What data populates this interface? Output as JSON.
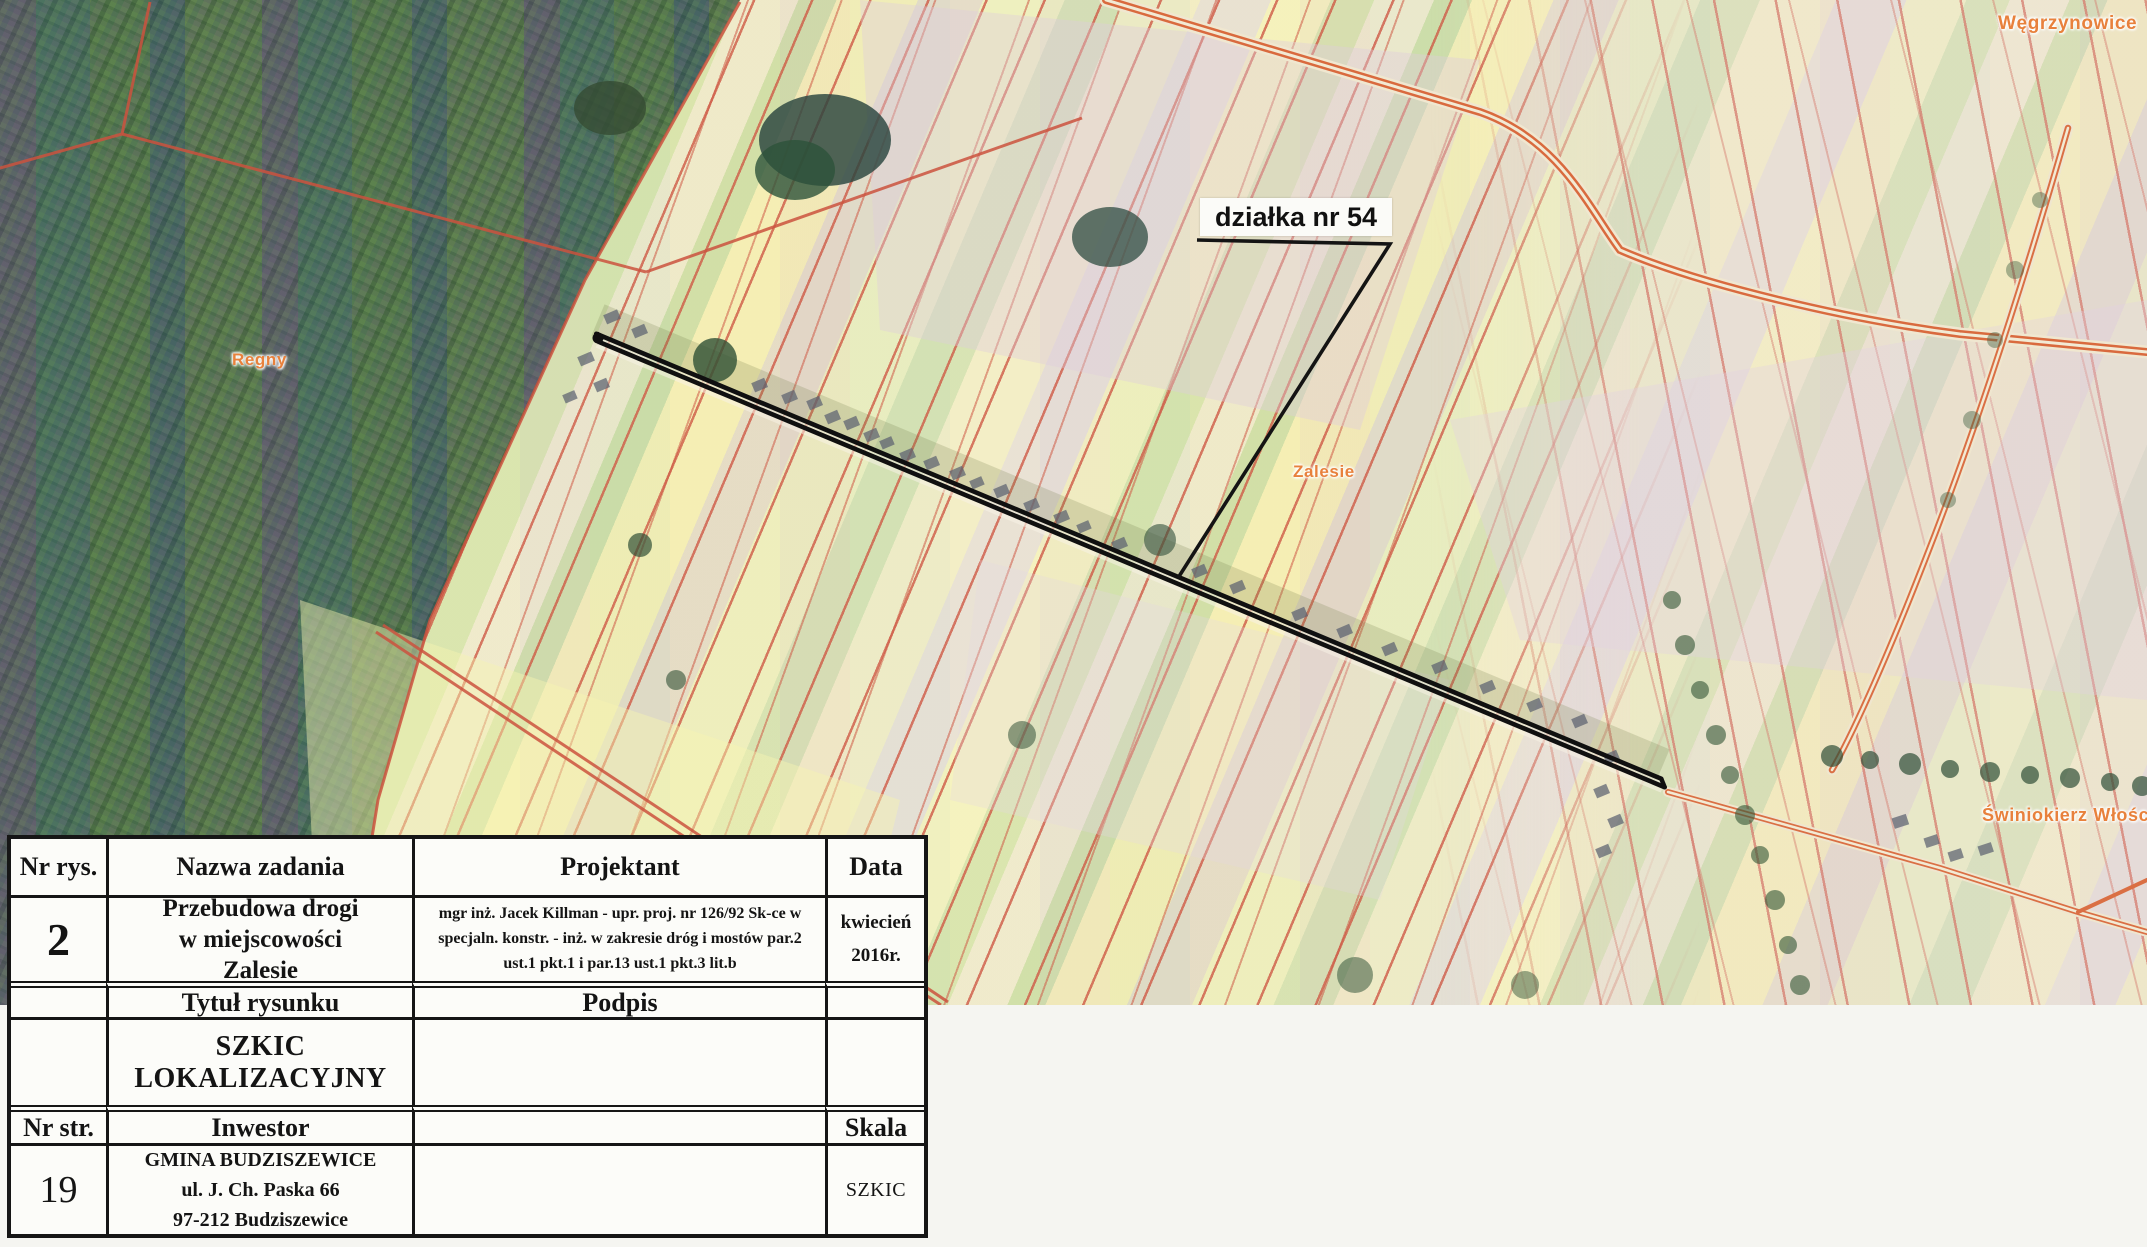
{
  "map": {
    "annotation": "działka nr 54",
    "labels": {
      "regny": "Regny",
      "zalesie": "Zalesie",
      "wegrzynowice": "Węgrzynowice",
      "swiniokierz": "Świniokierz Włościań"
    },
    "features": {
      "project_road": "black double line marking reconstructed road section through Zalesie",
      "cadastral_lines": "red parcel boundary lines over aerial orthophoto",
      "forest": "dark wooded area in upper-left with scanner color banding"
    },
    "colors": {
      "cadastral_red": "#ce5a46",
      "label_orange": "#e8813c",
      "road_black": "#111111",
      "paper": "#fcfcf9"
    }
  },
  "titleblock": {
    "h_nr_rys": "Nr rys.",
    "h_nazwa": "Nazwa zadania",
    "h_projektant": "Projektant",
    "h_data": "Data",
    "nr_rys": "2",
    "nazwa_l1": "Przebudowa drogi",
    "nazwa_l2": "w miejscowości",
    "nazwa_l3": "Zalesie",
    "projektant": "mgr inż. Jacek Killman - upr. proj. nr 126/92 Sk-ce w specjaln. konstr. - inż. w zakresie dróg i mostów par.2 ust.1 pkt.1 i par.13 ust.1 pkt.3 lit.b",
    "data_l1": "kwiecień",
    "data_l2": "2016r.",
    "h_tytul": "Tytuł rysunku",
    "h_podpis": "Podpis",
    "tytul": "SZKIC LOKALIZACYJNY",
    "h_nr_str": "Nr str.",
    "h_inwestor": "Inwestor",
    "h_skala": "Skala",
    "nr_str": "19",
    "inwestor_l1": "GMINA BUDZISZEWICE",
    "inwestor_l2": "ul. J. Ch. Paska 66",
    "inwestor_l3": "97-212 Budziszewice",
    "skala": "SZKIC"
  }
}
